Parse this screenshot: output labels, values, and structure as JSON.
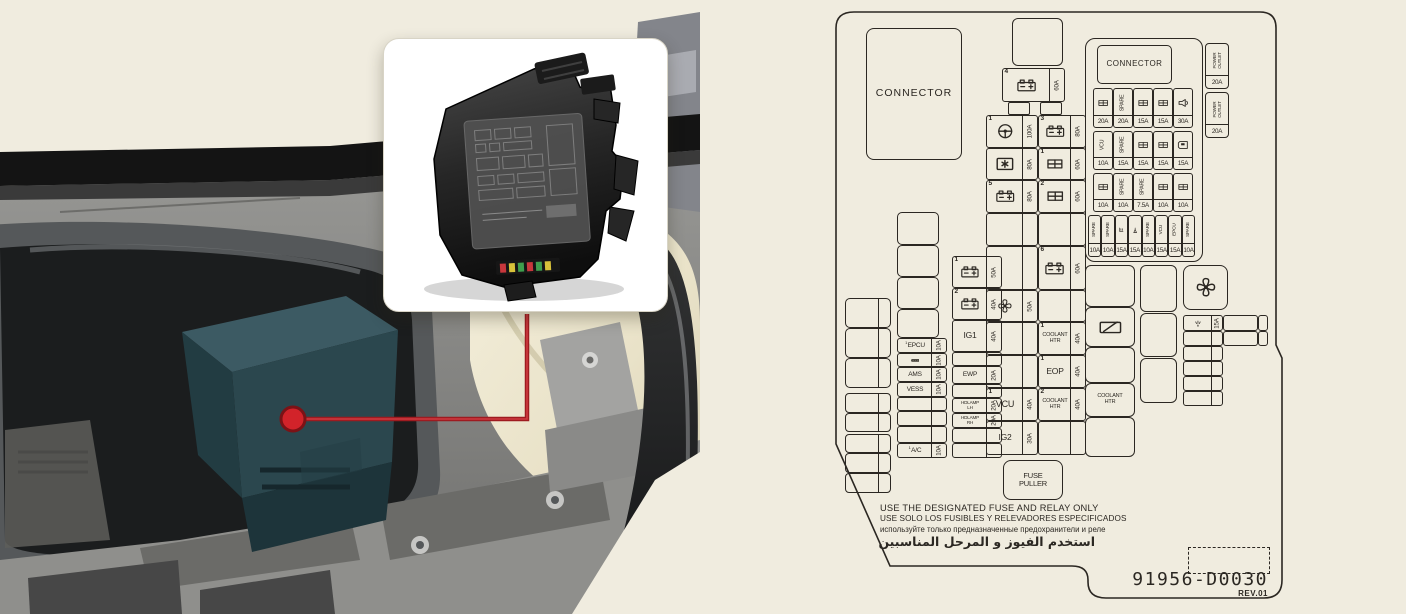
{
  "page": {
    "background": "#f0ecdf",
    "ink": "#2b2722"
  },
  "photo": {
    "callout_dot_color": "#d2232a",
    "callout_line_color": "#9e1b20",
    "fusebox_color": "#2b474e"
  },
  "diagram": {
    "warnings": [
      "USE THE DESIGNATED FUSE AND RELAY ONLY",
      "USE SOLO LOS FUSIBLES Y RELEVADORES ESPECIFICADOS",
      "используйте только предназначенные предохранители и реле",
      "استخدم الفيوز و المرحل المناسبين"
    ],
    "part_number": "91956-D0030",
    "revision": "REV.01",
    "boxes": [
      {
        "n": "connector-box-left",
        "x": 36,
        "y": 28,
        "w": 96,
        "h": 132,
        "r": 8,
        "lab": "CONNECTOR",
        "fs": 10.5,
        "ls": 1
      },
      {
        "n": "relay-slot",
        "x": 182,
        "y": 18,
        "w": 51,
        "h": 48,
        "r": 6
      },
      {
        "n": "fuse-4",
        "x": 172,
        "y": 68,
        "w": 63,
        "h": 34,
        "num": "4",
        "icon": "battery",
        "as": 14,
        "amp": "60A"
      },
      {
        "n": "tab",
        "x": 178,
        "y": 102,
        "w": 22,
        "h": 13,
        "r": 2
      },
      {
        "n": "tab",
        "x": 210,
        "y": 102,
        "w": 22,
        "h": 13,
        "r": 2
      },
      {
        "n": "fuse-1-steering",
        "x": 156,
        "y": 115,
        "w": 52,
        "h": 33,
        "num": "1",
        "icon": "steering",
        "as": 14,
        "amp": "100A"
      },
      {
        "n": "fuse-module",
        "x": 156,
        "y": 148,
        "w": 52,
        "h": 32,
        "icon": "module",
        "as": 14,
        "amp": "80A"
      },
      {
        "n": "fuse-5",
        "x": 156,
        "y": 180,
        "w": 52,
        "h": 33,
        "num": "5",
        "icon": "battery",
        "as": 14,
        "amp": "80A"
      },
      {
        "n": "slot",
        "x": 156,
        "y": 213,
        "w": 52,
        "h": 33,
        "as": 14
      },
      {
        "n": "slot",
        "x": 156,
        "y": 246,
        "w": 52,
        "h": 44,
        "as": 14
      },
      {
        "n": "fuse-fan",
        "x": 156,
        "y": 290,
        "w": 52,
        "h": 32,
        "icon": "fan",
        "as": 14,
        "amp": "50A"
      },
      {
        "n": "slot",
        "x": 156,
        "y": 322,
        "w": 52,
        "h": 33,
        "as": 14
      },
      {
        "n": "slot",
        "x": 156,
        "y": 355,
        "w": 52,
        "h": 33,
        "as": 14
      },
      {
        "n": "fuse-vcu",
        "x": 156,
        "y": 388,
        "w": 52,
        "h": 33,
        "num": "1",
        "lab": "VCU",
        "fs": 9,
        "as": 14,
        "amp": "40A"
      },
      {
        "n": "fuse-ig2",
        "x": 156,
        "y": 421,
        "w": 52,
        "h": 34,
        "lab": "IG2",
        "fs": 8.5,
        "as": 14,
        "amp": "30A"
      },
      {
        "n": "fuse-3",
        "x": 208,
        "y": 115,
        "w": 48,
        "h": 33,
        "num": "3",
        "icon": "battery",
        "as": 14,
        "amp": "80A"
      },
      {
        "n": "fuse-eb-1",
        "x": 208,
        "y": 148,
        "w": 48,
        "h": 32,
        "num": "1",
        "icon": "ebgrid",
        "as": 14,
        "amp": "60A"
      },
      {
        "n": "fuse-eb-2",
        "x": 208,
        "y": 180,
        "w": 48,
        "h": 33,
        "num": "2",
        "icon": "ebgrid",
        "as": 14,
        "amp": "60A"
      },
      {
        "n": "slot",
        "x": 208,
        "y": 213,
        "w": 48,
        "h": 33,
        "as": 14
      },
      {
        "n": "fuse-6",
        "x": 208,
        "y": 246,
        "w": 48,
        "h": 44,
        "num": "6",
        "icon": "battery",
        "as": 14,
        "amp": "60A"
      },
      {
        "n": "slot",
        "x": 208,
        "y": 290,
        "w": 48,
        "h": 32,
        "as": 14
      },
      {
        "n": "fuse-coolant-htr-1",
        "x": 208,
        "y": 322,
        "w": 48,
        "h": 33,
        "num": "1",
        "lab": "COOLANT\nHTR",
        "fs": 5.5,
        "as": 14,
        "amp": "40A"
      },
      {
        "n": "fuse-eop",
        "x": 208,
        "y": 355,
        "w": 48,
        "h": 33,
        "num": "1",
        "lab": "EOP",
        "fs": 8.5,
        "as": 14,
        "amp": "40A"
      },
      {
        "n": "fuse-coolant-htr-2",
        "x": 208,
        "y": 388,
        "w": 48,
        "h": 33,
        "num": "2",
        "lab": "COOLANT\nHTR",
        "fs": 5.5,
        "as": 14,
        "amp": "40A"
      },
      {
        "n": "slot",
        "x": 208,
        "y": 421,
        "w": 48,
        "h": 34,
        "as": 14
      },
      {
        "n": "fuse-puller",
        "x": 173,
        "y": 460,
        "w": 60,
        "h": 40,
        "r": 8,
        "lab": "FUSE\nPULLER",
        "fs": 7.5
      },
      {
        "n": "relay-slot",
        "x": 15,
        "y": 298,
        "w": 46,
        "h": 30,
        "r": 5,
        "dv": 32
      },
      {
        "n": "relay-slot",
        "x": 15,
        "y": 328,
        "w": 46,
        "h": 30,
        "r": 5,
        "dv": 32
      },
      {
        "n": "relay-slot",
        "x": 15,
        "y": 358,
        "w": 46,
        "h": 30,
        "r": 5,
        "dv": 32
      },
      {
        "n": "relay-slot",
        "x": 15,
        "y": 393,
        "w": 46,
        "h": 20,
        "r": 4,
        "dv": 32
      },
      {
        "n": "relay-slot",
        "x": 15,
        "y": 413,
        "w": 46,
        "h": 19,
        "r": 4,
        "dv": 32
      },
      {
        "n": "relay-slot",
        "x": 15,
        "y": 434,
        "w": 46,
        "h": 19,
        "r": 4,
        "dv": 32
      },
      {
        "n": "relay-slot",
        "x": 15,
        "y": 453,
        "w": 46,
        "h": 20,
        "r": 4,
        "dv": 32
      },
      {
        "n": "relay-slot",
        "x": 15,
        "y": 473,
        "w": 46,
        "h": 20,
        "r": 4,
        "dv": 32
      },
      {
        "n": "relay-slot",
        "x": 67,
        "y": 212,
        "w": 42,
        "h": 33,
        "r": 5
      },
      {
        "n": "relay-slot",
        "x": 67,
        "y": 245,
        "w": 42,
        "h": 32,
        "r": 5
      },
      {
        "n": "relay-slot",
        "x": 67,
        "y": 277,
        "w": 42,
        "h": 32,
        "r": 5
      },
      {
        "n": "relay-slot",
        "x": 67,
        "y": 309,
        "w": 42,
        "h": 29,
        "r": 5
      },
      {
        "n": "fuse-epcu",
        "x": 67,
        "y": 338,
        "w": 50,
        "h": 15,
        "sup": "1",
        "lab": "EPCU",
        "fs": 6.5,
        "as": 14,
        "amp": "10A"
      },
      {
        "n": "fuse-ieb",
        "x": 67,
        "y": 353,
        "w": 50,
        "h": 14,
        "icon": "darklabel",
        "as": 14,
        "amp": "10A"
      },
      {
        "n": "fuse-ams",
        "x": 67,
        "y": 367,
        "w": 50,
        "h": 15,
        "lab": "AMS",
        "fs": 6.5,
        "as": 14,
        "amp": "10A"
      },
      {
        "n": "fuse-vess",
        "x": 67,
        "y": 382,
        "w": 50,
        "h": 15,
        "lab": "VESS",
        "fs": 6.5,
        "as": 14,
        "amp": "10A"
      },
      {
        "n": "slot",
        "x": 67,
        "y": 397,
        "w": 50,
        "h": 14,
        "as": 14
      },
      {
        "n": "slot",
        "x": 67,
        "y": 411,
        "w": 50,
        "h": 15,
        "as": 14
      },
      {
        "n": "slot",
        "x": 67,
        "y": 426,
        "w": 50,
        "h": 17,
        "as": 14
      },
      {
        "n": "fuse-ac",
        "x": 67,
        "y": 443,
        "w": 50,
        "h": 15,
        "sup": "1",
        "lab": "A/C",
        "fs": 6.5,
        "as": 14,
        "amp": "10A"
      },
      {
        "n": "fuse-bat-1",
        "x": 122,
        "y": 256,
        "w": 50,
        "h": 32,
        "num": "1",
        "icon": "battery",
        "as": 14,
        "amp": "50A"
      },
      {
        "n": "fuse-bat-2",
        "x": 122,
        "y": 288,
        "w": 50,
        "h": 32,
        "num": "2",
        "icon": "battery",
        "as": 14,
        "amp": "40A"
      },
      {
        "n": "fuse-ig1",
        "x": 122,
        "y": 320,
        "w": 50,
        "h": 32,
        "lab": "IG1",
        "fs": 8.5,
        "as": 14,
        "amp": "40A"
      },
      {
        "n": "slot",
        "x": 122,
        "y": 352,
        "w": 50,
        "h": 14,
        "as": 14
      },
      {
        "n": "fuse-ewp",
        "x": 122,
        "y": 366,
        "w": 50,
        "h": 18,
        "lab": "EWP",
        "fs": 6.5,
        "as": 14,
        "amp": "20A"
      },
      {
        "n": "slot",
        "x": 122,
        "y": 384,
        "w": 50,
        "h": 14,
        "as": 14
      },
      {
        "n": "fuse-hdlamp-lh",
        "x": 122,
        "y": 398,
        "w": 50,
        "h": 15,
        "lab": "HDLAMP\nLH",
        "fs": 4.6,
        "as": 14,
        "amp": "20A"
      },
      {
        "n": "fuse-hdlamp-rh",
        "x": 122,
        "y": 413,
        "w": 50,
        "h": 15,
        "lab": "HDLAMP\nRH",
        "fs": 4.6,
        "as": 14,
        "amp": "20A"
      },
      {
        "n": "slot",
        "x": 122,
        "y": 428,
        "w": 50,
        "h": 15,
        "as": 14
      },
      {
        "n": "slot",
        "x": 122,
        "y": 443,
        "w": 50,
        "h": 15,
        "as": 14
      },
      {
        "n": "relay-slot",
        "x": 255,
        "y": 265,
        "w": 50,
        "h": 42,
        "r": 6
      },
      {
        "n": "relay-rear-wiper",
        "x": 255,
        "y": 307,
        "w": 50,
        "h": 40,
        "r": 6,
        "icon": "wiper"
      },
      {
        "n": "relay-slot",
        "x": 255,
        "y": 347,
        "w": 50,
        "h": 36,
        "r": 6
      },
      {
        "n": "relay-coolant-htr",
        "x": 255,
        "y": 383,
        "w": 50,
        "h": 34,
        "r": 6,
        "lab": "COOLANT\nHTR",
        "fs": 5.5
      },
      {
        "n": "relay-slot",
        "x": 255,
        "y": 417,
        "w": 50,
        "h": 40,
        "r": 6
      },
      {
        "n": "relay-slot",
        "x": 310,
        "y": 265,
        "w": 37,
        "h": 47,
        "r": 6
      },
      {
        "n": "relay-slot",
        "x": 310,
        "y": 313,
        "w": 37,
        "h": 44,
        "r": 6
      },
      {
        "n": "relay-slot",
        "x": 310,
        "y": 358,
        "w": 37,
        "h": 45,
        "r": 6
      },
      {
        "n": "relay-fan",
        "x": 353,
        "y": 265,
        "w": 45,
        "h": 45,
        "r": 8,
        "icon": "fan"
      },
      {
        "n": "fuse-washer",
        "x": 353,
        "y": 315,
        "w": 40,
        "h": 16,
        "icon": "washer",
        "as": 10,
        "amp": "15A"
      },
      {
        "n": "slot",
        "x": 353,
        "y": 331,
        "w": 40,
        "h": 15,
        "as": 10
      },
      {
        "n": "slot",
        "x": 353,
        "y": 346,
        "w": 40,
        "h": 15,
        "as": 10
      },
      {
        "n": "slot",
        "x": 353,
        "y": 361,
        "w": 40,
        "h": 15,
        "as": 10
      },
      {
        "n": "slot",
        "x": 353,
        "y": 376,
        "w": 40,
        "h": 15,
        "as": 10
      },
      {
        "n": "slot",
        "x": 353,
        "y": 391,
        "w": 40,
        "h": 15,
        "as": 10
      },
      {
        "n": "slot",
        "x": 393,
        "y": 315,
        "w": 35,
        "h": 16
      },
      {
        "n": "slot",
        "x": 428,
        "y": 315,
        "w": 10,
        "h": 16
      },
      {
        "n": "slot",
        "x": 393,
        "y": 331,
        "w": 35,
        "h": 15
      },
      {
        "n": "slot",
        "x": 428,
        "y": 331,
        "w": 10,
        "h": 15
      },
      {
        "n": "fuse-grid-panel",
        "x": 255,
        "y": 38,
        "w": 118,
        "h": 224,
        "r": 10,
        "panel": true
      },
      {
        "n": "connector-box-top",
        "x": 267,
        "y": 45,
        "w": 75,
        "h": 39,
        "r": 5,
        "lab": "CONNECTOR",
        "fs": 8,
        "ls": 0.5
      },
      {
        "n": "fuse-cell",
        "x": 263,
        "y": 88,
        "w": 20,
        "h": 40,
        "icon": "ebgrid",
        "ab": 11,
        "amp": "20A"
      },
      {
        "n": "fuse-cell",
        "x": 283,
        "y": 88,
        "w": 20,
        "h": 40,
        "lab": "SPARE",
        "rot": 1,
        "fs": 5.3,
        "ab": 11,
        "amp": "20A"
      },
      {
        "n": "fuse-cell",
        "x": 303,
        "y": 88,
        "w": 20,
        "h": 40,
        "icon": "ebgrid",
        "ab": 11,
        "amp": "15A"
      },
      {
        "n": "fuse-cell",
        "x": 323,
        "y": 88,
        "w": 20,
        "h": 40,
        "icon": "ebgrid",
        "ab": 11,
        "amp": "15A"
      },
      {
        "n": "fuse-cell",
        "x": 343,
        "y": 88,
        "w": 20,
        "h": 40,
        "icon": "horn",
        "ab": 11,
        "amp": "30A"
      },
      {
        "n": "fuse-cell",
        "x": 263,
        "y": 131,
        "w": 20,
        "h": 39,
        "lab": "VCU",
        "rot": 1,
        "fs": 5.3,
        "ab": 11,
        "amp": "10A"
      },
      {
        "n": "fuse-cell",
        "x": 283,
        "y": 131,
        "w": 20,
        "h": 39,
        "lab": "SPARE",
        "rot": 1,
        "fs": 5.3,
        "ab": 11,
        "amp": "15A"
      },
      {
        "n": "fuse-cell",
        "x": 303,
        "y": 131,
        "w": 20,
        "h": 39,
        "icon": "ebgrid",
        "ab": 11,
        "amp": "15A"
      },
      {
        "n": "fuse-cell",
        "x": 323,
        "y": 131,
        "w": 20,
        "h": 39,
        "icon": "ebgrid",
        "ab": 11,
        "amp": "15A"
      },
      {
        "n": "fuse-cell",
        "x": 343,
        "y": 131,
        "w": 20,
        "h": 39,
        "icon": "door",
        "ab": 11,
        "amp": "15A"
      },
      {
        "n": "fuse-cell",
        "x": 263,
        "y": 173,
        "w": 20,
        "h": 39,
        "icon": "ebgrid",
        "ab": 11,
        "amp": "10A"
      },
      {
        "n": "fuse-cell",
        "x": 283,
        "y": 173,
        "w": 20,
        "h": 39,
        "lab": "SPARE",
        "rot": 1,
        "fs": 5.3,
        "ab": 11,
        "amp": "10A"
      },
      {
        "n": "fuse-cell",
        "x": 303,
        "y": 173,
        "w": 20,
        "h": 39,
        "lab": "SPARE",
        "rot": 1,
        "fs": 5.3,
        "ab": 11,
        "amp": "7.5A"
      },
      {
        "n": "fuse-cell",
        "x": 323,
        "y": 173,
        "w": 20,
        "h": 39,
        "icon": "ebgrid",
        "ab": 11,
        "amp": "10A"
      },
      {
        "n": "fuse-cell",
        "x": 343,
        "y": 173,
        "w": 20,
        "h": 39,
        "icon": "ebgrid",
        "ab": 11,
        "amp": "10A"
      },
      {
        "n": "fuse-cell",
        "x": 258,
        "y": 215,
        "w": 13.4,
        "h": 42,
        "lab": "SPARE",
        "rot": 1,
        "fs": 4.8,
        "ab": 12,
        "amp": "10A"
      },
      {
        "n": "fuse-cell",
        "x": 271.4,
        "y": 215,
        "w": 13.4,
        "h": 42,
        "lab": "SPARE",
        "rot": 1,
        "fs": 4.8,
        "ab": 12,
        "amp": "10A"
      },
      {
        "n": "fuse-cell",
        "x": 284.8,
        "y": 215,
        "w": 13.4,
        "h": 42,
        "icon": "seatheat",
        "ab": 12,
        "amp": "15A"
      },
      {
        "n": "fuse-cell",
        "x": 298.2,
        "y": 215,
        "w": 13.4,
        "h": 42,
        "icon": "spotlight",
        "ab": 12,
        "amp": "15A"
      },
      {
        "n": "fuse-cell",
        "x": 311.6,
        "y": 215,
        "w": 13.4,
        "h": 42,
        "lab": "SPARE",
        "rot": 1,
        "fs": 4.8,
        "ab": 12,
        "amp": "10A"
      },
      {
        "n": "fuse-cell",
        "x": 325,
        "y": 215,
        "w": 13.4,
        "h": 42,
        "lab": "VCU",
        "rot": 1,
        "fs": 4.8,
        "ab": 12,
        "amp": "15A"
      },
      {
        "n": "fuse-cell",
        "x": 338.4,
        "y": 215,
        "w": 13.4,
        "h": 42,
        "lab": "EPCU",
        "rot": 1,
        "fs": 4.8,
        "ab": 12,
        "amp": "15A"
      },
      {
        "n": "fuse-cell",
        "x": 351.8,
        "y": 215,
        "w": 13.4,
        "h": 42,
        "lab": "SPARE",
        "rot": 1,
        "fs": 4.8,
        "ab": 12,
        "amp": "10A"
      },
      {
        "n": "fuse-power-outlet-1",
        "x": 375,
        "y": 43,
        "w": 24,
        "h": 46,
        "r": 4,
        "lab": "POWER\nOUTLET",
        "rot": 1,
        "fs": 4.5,
        "ab": 12,
        "amp": "20A"
      },
      {
        "n": "fuse-power-outlet-2",
        "x": 375,
        "y": 92,
        "w": 24,
        "h": 46,
        "r": 4,
        "lab": "POWER\nOUTLET",
        "rot": 1,
        "fs": 4.5,
        "ab": 12,
        "amp": "20A"
      }
    ]
  }
}
